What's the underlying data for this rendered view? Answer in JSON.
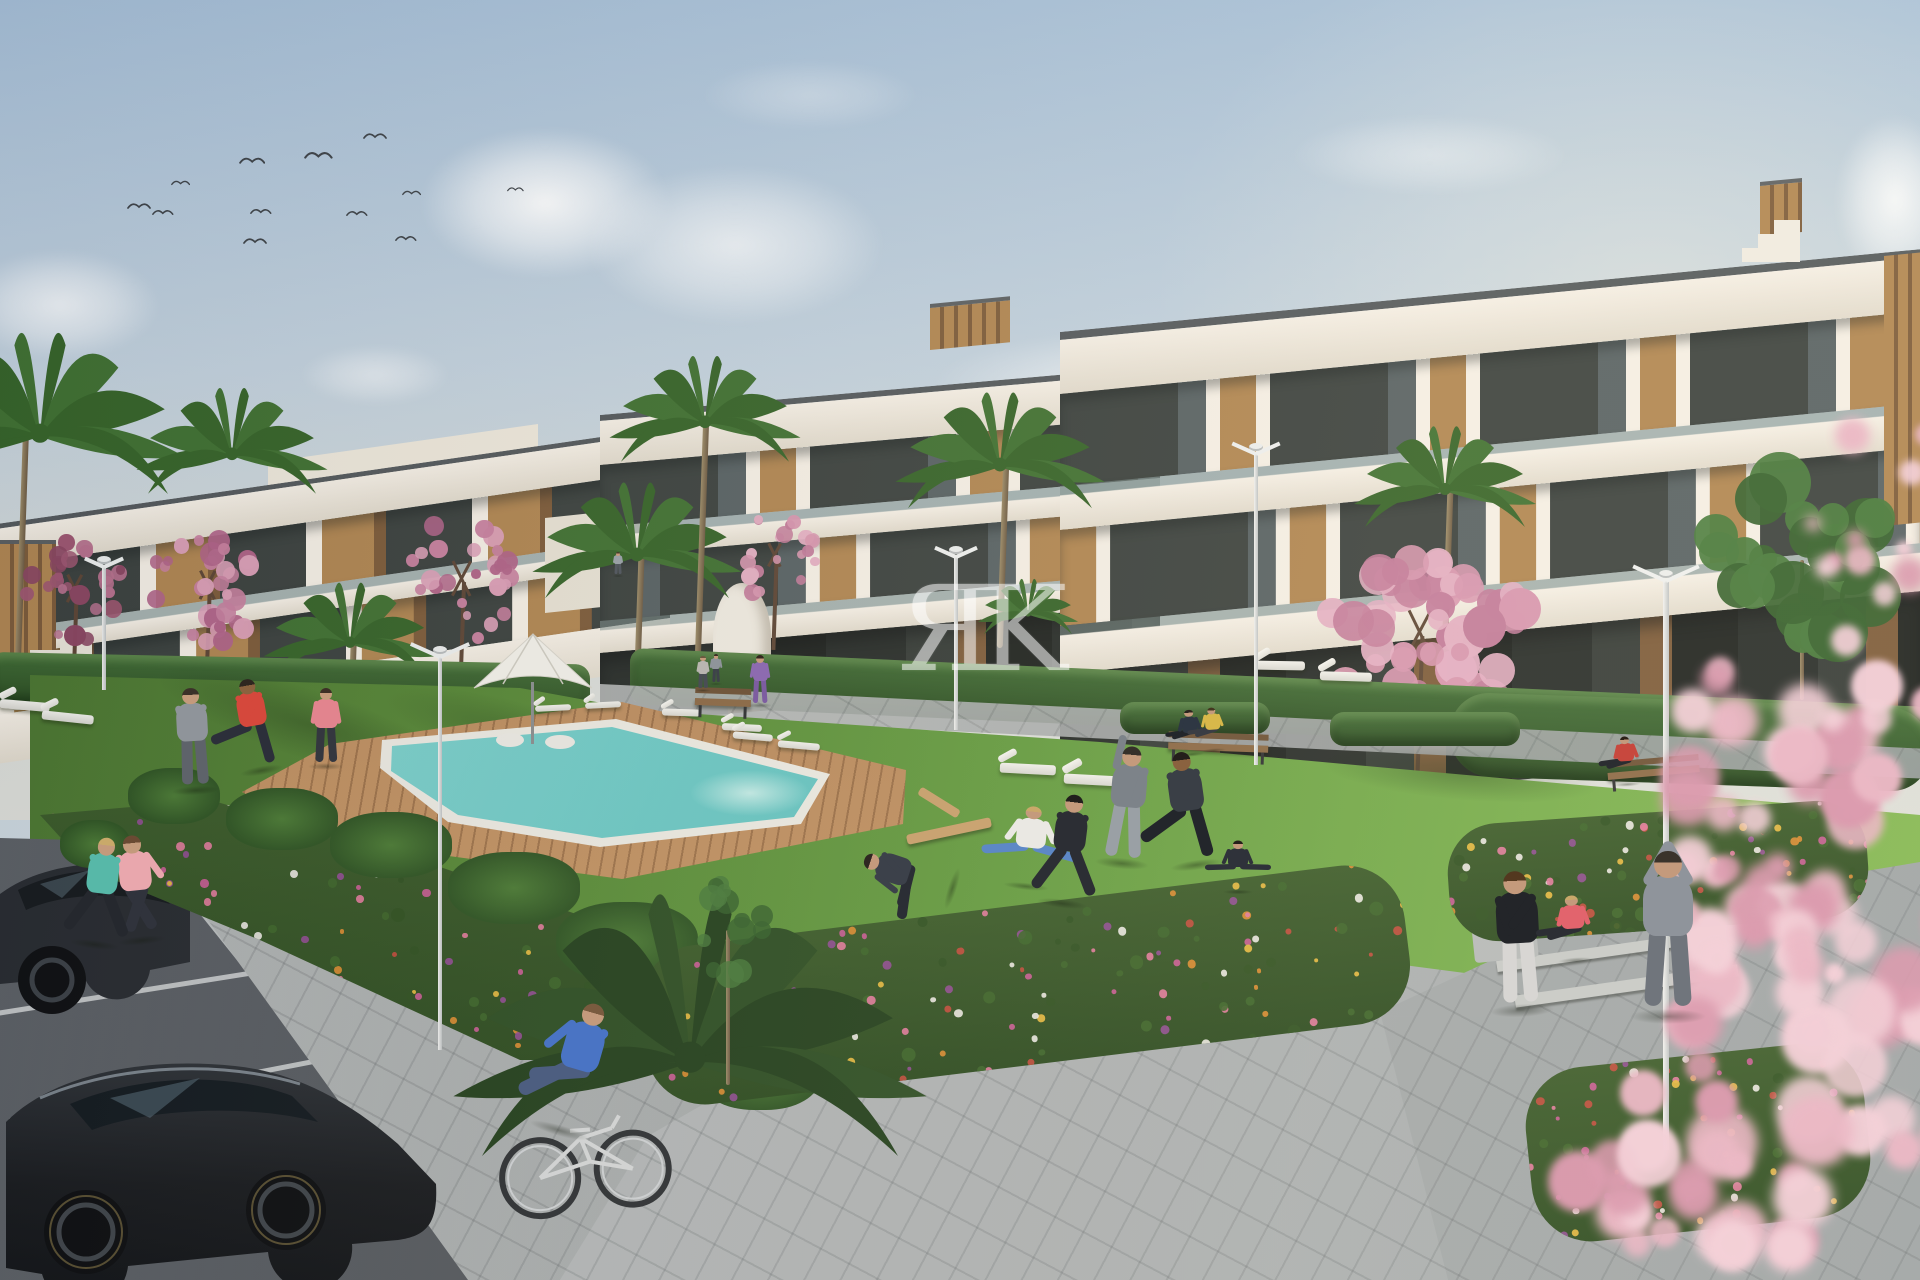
{
  "scene": {
    "type": "architectural-render",
    "description": "New-build white residential apartment complex with wood accents, communal lawn, swimming pool with timber deck, flower beds, joggers, cyclist and parking in front",
    "width": 1920,
    "height": 1280
  },
  "watermark": {
    "text": "ЯK",
    "color": "#ffffff",
    "opacity": 0.55
  },
  "palette": {
    "sky_top": "#a7c0d8",
    "sky_mid": "#c3d2de",
    "sky_low": "#d8dcd8",
    "bldg_white": "#f5efe5",
    "bldg_shade": "#e2dbcd",
    "roof_cap": "#53585b",
    "glass": "#3a403d",
    "glass_light": "#566062",
    "wood": "#b08550",
    "wood_dark": "#7c5a38",
    "hedge": "#31552a",
    "lawn": "#5c8f3a",
    "lawn_light": "#83b455",
    "pool": "#58bdbd",
    "pool_light": "#a7e2dc",
    "deck": "#c79a62",
    "pavement": "#a8acad",
    "road": "#565a5f",
    "line_white": "#d9dcdc",
    "blossom": "#d795ae",
    "blossom_deep": "#a25a77",
    "flower_orange": "#d98a2f",
    "flower_magenta": "#c85b93",
    "flower_purple": "#8e4b8f",
    "flower_yellow": "#e6b93f",
    "lamp": "#eceeec",
    "car": "#17191c",
    "skin": "#c49a7c"
  },
  "birds": [
    {
      "x": 127,
      "y": 200,
      "s": 1.0
    },
    {
      "x": 152,
      "y": 207,
      "s": 0.9
    },
    {
      "x": 171,
      "y": 178,
      "s": 0.8
    },
    {
      "x": 239,
      "y": 154,
      "s": 1.1
    },
    {
      "x": 250,
      "y": 206,
      "s": 0.9
    },
    {
      "x": 243,
      "y": 235,
      "s": 1.0
    },
    {
      "x": 304,
      "y": 148,
      "s": 1.2
    },
    {
      "x": 346,
      "y": 208,
      "s": 0.9
    },
    {
      "x": 363,
      "y": 130,
      "s": 1.0
    },
    {
      "x": 402,
      "y": 188,
      "s": 0.8
    },
    {
      "x": 395,
      "y": 233,
      "s": 0.9
    },
    {
      "x": 507,
      "y": 185,
      "s": 0.7
    }
  ],
  "clouds": [
    {
      "x": 420,
      "y": 128,
      "w": 250,
      "h": 150,
      "o": 0.95
    },
    {
      "x": 585,
      "y": 165,
      "w": 300,
      "h": 160,
      "o": 0.7
    },
    {
      "x": -40,
      "y": 250,
      "w": 200,
      "h": 110,
      "o": 0.75
    },
    {
      "x": 300,
      "y": 345,
      "w": 150,
      "h": 60,
      "o": 0.5
    },
    {
      "x": 930,
      "y": 330,
      "w": 420,
      "h": 110,
      "o": 0.55
    },
    {
      "x": 960,
      "y": 390,
      "w": 300,
      "h": 70,
      "o": 0.5
    },
    {
      "x": 1290,
      "y": 115,
      "w": 280,
      "h": 80,
      "o": 0.4
    },
    {
      "x": 1835,
      "y": 115,
      "w": 120,
      "h": 170,
      "o": 0.85
    },
    {
      "x": 1580,
      "y": 330,
      "w": 260,
      "h": 70,
      "o": 0.4
    },
    {
      "x": 700,
      "y": 60,
      "w": 220,
      "h": 70,
      "o": 0.3
    }
  ],
  "palms": [
    {
      "id": "palm-left-edge",
      "x": 40,
      "y": 430,
      "s": 1.6,
      "trunk": {
        "x": 22,
        "to": 660
      },
      "layer": "back"
    },
    {
      "id": "palm-left-roof",
      "x": 232,
      "y": 452,
      "s": 1.05,
      "trunk": null,
      "layer": "back"
    },
    {
      "id": "palm-court-tall",
      "x": 637,
      "y": 552,
      "s": 1.15,
      "trunk": {
        "x": 639,
        "to": 702
      },
      "layer": "back"
    },
    {
      "id": "palm-court-high",
      "x": 705,
      "y": 420,
      "s": 1.05,
      "trunk": {
        "x": 702,
        "to": 658
      },
      "layer": "back"
    },
    {
      "id": "palm-right-tall",
      "x": 1000,
      "y": 462,
      "s": 1.15,
      "trunk": {
        "x": 1003,
        "to": 648
      },
      "layer": "back"
    },
    {
      "id": "palm-right-far",
      "x": 1445,
      "y": 487,
      "s": 1.0,
      "trunk": {
        "x": 1447,
        "to": 688
      },
      "layer": "back"
    },
    {
      "id": "palm-poolside",
      "x": 350,
      "y": 640,
      "s": 0.95,
      "trunk": {
        "x": 352,
        "to": 742
      },
      "layer": "back"
    },
    {
      "id": "palm-bush",
      "x": 1028,
      "y": 612,
      "s": 0.55,
      "trunk": null,
      "layer": "back"
    },
    {
      "id": "palm-foreground",
      "x": 690,
      "y": 1052,
      "s": 2.6,
      "dark": true,
      "trunk": null,
      "layer": "fore"
    }
  ],
  "green_trees": [
    {
      "id": "green-tree-right",
      "x": 1805,
      "y": 560,
      "rx": 105,
      "ry": 95,
      "trunk": {
        "x": 1802,
        "to": 700
      },
      "layer": "back"
    },
    {
      "id": "sapling-bed",
      "x": 728,
      "y": 930,
      "rx": 50,
      "ry": 60,
      "trunk": {
        "x": 728,
        "to": 1085
      },
      "sparse": true,
      "layer": "fore"
    }
  ],
  "blossoms": [
    {
      "id": "blossom-far-left",
      "x": 75,
      "y": 592,
      "rx": 58,
      "ry": 62,
      "trunkTo": 688,
      "tone": "deep"
    },
    {
      "id": "blossom-left",
      "x": 208,
      "y": 588,
      "rx": 66,
      "ry": 64,
      "trunkTo": 690,
      "tone": "mid"
    },
    {
      "id": "blossom-mid-left",
      "x": 462,
      "y": 582,
      "rx": 58,
      "ry": 78,
      "trunkTo": 700,
      "tone": "mid"
    },
    {
      "id": "blossom-court",
      "x": 775,
      "y": 558,
      "rx": 46,
      "ry": 52,
      "trunkTo": 650,
      "tone": "light"
    },
    {
      "id": "blossom-right",
      "x": 1420,
      "y": 636,
      "rx": 118,
      "ry": 95,
      "trunkTo": 772,
      "tone": "light"
    }
  ],
  "blossoms_fore": [
    {
      "x": 1800,
      "y": 740,
      "rx": 150,
      "ry": 120,
      "n": 26
    },
    {
      "x": 1830,
      "y": 1020,
      "rx": 180,
      "ry": 200,
      "n": 34
    },
    {
      "x": 1700,
      "y": 1180,
      "rx": 160,
      "ry": 120,
      "n": 22
    },
    {
      "x": 1880,
      "y": 500,
      "rx": 90,
      "ry": 130,
      "n": 12
    },
    {
      "x": 1760,
      "y": 920,
      "rx": 120,
      "ry": 90,
      "n": 16
    }
  ],
  "shrubs": [
    [
      128,
      768,
      92,
      56
    ],
    [
      226,
      788,
      112,
      62
    ],
    [
      330,
      812,
      122,
      66
    ],
    [
      448,
      852,
      132,
      72
    ],
    [
      556,
      902,
      142,
      80
    ],
    [
      636,
      972,
      150,
      92
    ],
    [
      60,
      820,
      70,
      48
    ],
    [
      700,
      1040,
      120,
      70
    ]
  ],
  "flower_beds": [
    {
      "mount": "bedL",
      "count": 175,
      "seed": 11
    },
    {
      "mount": "bedR",
      "count": 125,
      "seed": 23
    },
    {
      "mount": "bedSteps",
      "count": 95,
      "seed": 37
    },
    {
      "mount": "bedBR",
      "count": 75,
      "seed": 53
    }
  ],
  "flower_colors": [
    "#d98a2f",
    "#e6b93f",
    "#c85b93",
    "#8e4b8f",
    "#c04a3a",
    "#e8e6e0",
    "#e07a9a"
  ],
  "loungers": [
    {
      "x": 535,
      "y": 697,
      "w": 36,
      "rot": -3
    },
    {
      "x": 585,
      "y": 694,
      "w": 36,
      "rot": -3
    },
    {
      "x": 662,
      "y": 701,
      "w": 38,
      "rot": 2
    },
    {
      "x": 722,
      "y": 715,
      "w": 40,
      "rot": 3
    },
    {
      "x": 733,
      "y": 724,
      "w": 40,
      "rot": 5
    },
    {
      "x": 778,
      "y": 733,
      "w": 42,
      "rot": 5
    },
    {
      "x": 1000,
      "y": 752,
      "w": 56,
      "rot": 3
    },
    {
      "x": 1064,
      "y": 762,
      "w": 58,
      "rot": 3
    },
    {
      "x": 1255,
      "y": 650,
      "w": 50,
      "rot": 1
    },
    {
      "x": 1320,
      "y": 661,
      "w": 52,
      "rot": 2
    },
    {
      "x": 0,
      "y": 690,
      "w": 50,
      "rot": 5
    },
    {
      "x": 42,
      "y": 702,
      "w": 52,
      "rot": 6
    }
  ],
  "benches": [
    {
      "id": "bench-court",
      "x": 695,
      "y": 688,
      "w": 56,
      "rot": 2
    },
    {
      "id": "bench-lawn",
      "x": 1168,
      "y": 733,
      "w": 100,
      "rot": 2
    },
    {
      "id": "bench-right",
      "x": 1608,
      "y": 758,
      "w": 92,
      "rot": -5
    }
  ],
  "lamps": [
    {
      "id": "lamp-pool",
      "x": 440,
      "head": 646,
      "bottom": 1050,
      "w": 56,
      "layer": "mid"
    },
    {
      "id": "lamp-right-lawn",
      "x": 1256,
      "head": 443,
      "bottom": 765,
      "w": 44,
      "layer": "mid"
    },
    {
      "id": "lamp-court",
      "x": 956,
      "head": 546,
      "bottom": 730,
      "w": 38,
      "layer": "mid"
    },
    {
      "id": "lamp-left",
      "x": 104,
      "head": 556,
      "bottom": 690,
      "w": 34,
      "layer": "mid"
    },
    {
      "id": "lamp-walkway",
      "x": 1666,
      "head": 570,
      "bottom": 1150,
      "w": 64,
      "layer": "fore"
    }
  ],
  "steps": [
    {
      "x": 1478,
      "y": 918,
      "w": 152,
      "h": 9,
      "rot": -8
    },
    {
      "x": 1496,
      "y": 948,
      "w": 188,
      "h": 11,
      "rot": -8
    },
    {
      "x": 1514,
      "y": 980,
      "w": 225,
      "h": 12,
      "rot": -8
    }
  ],
  "parking_lines": [
    {
      "x": -10,
      "y": 928,
      "w": 225,
      "rot": -8
    },
    {
      "x": -10,
      "y": 1012,
      "w": 305,
      "rot": -9
    },
    {
      "x": 10,
      "y": 1118,
      "w": 370,
      "rot": -11
    },
    {
      "x": 105,
      "y": 1248,
      "w": 430,
      "rot": -12
    }
  ],
  "bike": {
    "x": 494,
    "y": 1100,
    "w": 180,
    "rot": -4
  },
  "ball": {
    "x": 197,
    "y": 731,
    "r": 8
  },
  "people": [
    {
      "id": "jogger-teal",
      "x": 95,
      "y": 838,
      "h": 106,
      "pose": "run",
      "top": "#57b8a8",
      "bottom": "#25282e",
      "hair": "#c9a96a"
    },
    {
      "id": "jogger-pink",
      "x": 142,
      "y": 836,
      "h": 104,
      "pose": "runb",
      "top": "#e9a7ad",
      "bottom": "#30333c",
      "hair": "#6a4a33"
    },
    {
      "id": "cyclist",
      "x": 560,
      "y": 1000,
      "h": 130,
      "pose": "ride",
      "top": "#4a74c4",
      "bottom": "#4d5e80",
      "hair": "#7a5b3f"
    },
    {
      "id": "ball-player",
      "x": 196,
      "y": 688,
      "h": 102,
      "pose": "stand2",
      "top": "#8f949a",
      "bottom": "#5e636a",
      "hair": "#3c3129"
    },
    {
      "id": "red-kicker",
      "x": 262,
      "y": 678,
      "h": 92,
      "pose": "kick",
      "top": "#d5483c",
      "bottom": "#2c2f3a",
      "hair": "#2e2620",
      "skin": "#8a623f"
    },
    {
      "id": "poolside-woman",
      "x": 326,
      "y": 688,
      "h": 78,
      "pose": "stand",
      "top": "#e2848e",
      "bottom": "#34373f",
      "hair": "#3d2f26"
    },
    {
      "id": "purple-woman",
      "x": 760,
      "y": 655,
      "h": 50,
      "pose": "stand",
      "top": "#8d6bb0",
      "bottom": "#7d5da0",
      "hair": "#33281f"
    },
    {
      "id": "path-figure-a",
      "x": 703,
      "y": 656,
      "h": 34,
      "pose": "stand",
      "top": "#b9b6b0",
      "bottom": "#4a4e55",
      "hair": "#6a5a40"
    },
    {
      "id": "path-figure-b",
      "x": 716,
      "y": 654,
      "h": 30,
      "pose": "stand",
      "top": "#8f949a",
      "bottom": "#3e424a",
      "hair": "#3a2f24"
    },
    {
      "id": "path-figure-c",
      "x": 618,
      "y": 552,
      "h": 24,
      "pose": "stand",
      "top": "#9aa0a6",
      "bottom": "#555a61",
      "hair": "#4a3b2c"
    },
    {
      "id": "squatting-woman",
      "x": 1026,
      "y": 786,
      "h": 100,
      "pose": "squat",
      "top": "#eae8e3",
      "bottom": "#5d88c6",
      "hair": "#caa86a"
    },
    {
      "id": "hoodie-exerciser",
      "x": 1062,
      "y": 795,
      "h": 108,
      "pose": "run",
      "top": "#2c2e34",
      "bottom": "#2c2e34",
      "hair": "#22201d"
    },
    {
      "id": "arm-up-man",
      "x": 1122,
      "y": 747,
      "h": 116,
      "pose": "armup",
      "top": "#7d8389",
      "bottom": "#9aa0a5",
      "hair": "#36302a"
    },
    {
      "id": "leg-stretch-man",
      "x": 1196,
      "y": 752,
      "h": 112,
      "pose": "lunge",
      "top": "#3a3f46",
      "bottom": "#23262b",
      "hair": "#241f1b",
      "skin": "#8a623f"
    },
    {
      "id": "yoga-woman",
      "x": 1238,
      "y": 826,
      "h": 66,
      "pose": "yoga",
      "top": "#2f323a",
      "bottom": "#2f323a",
      "hair": "#241f1a"
    },
    {
      "id": "lying-man",
      "x": 952,
      "y": 796,
      "h": 92,
      "pose": "lie",
      "top": "#3c414a",
      "bottom": "#2b2e35",
      "hair": "#2e2722"
    },
    {
      "id": "bench-sitter-a",
      "x": 1192,
      "y": 702,
      "h": 52,
      "pose": "sit",
      "top": "#2e3743",
      "bottom": "#23262b",
      "hair": "#2a241e"
    },
    {
      "id": "bench-sitter-b",
      "x": 1214,
      "y": 700,
      "h": 50,
      "pose": "sit",
      "top": "#d8b84a",
      "bottom": "#3a3d44",
      "hair": "#44361f"
    },
    {
      "id": "bench-sitter-red",
      "x": 1628,
      "y": 728,
      "h": 56,
      "pose": "sit",
      "top": "#c8483e",
      "bottom": "#2b2d31",
      "hair": "#2c2017"
    },
    {
      "id": "standing-woman",
      "x": 1522,
      "y": 872,
      "h": 138,
      "pose": "stand2",
      "top": "#232529",
      "bottom": "#d8d6d3",
      "hair": "#53381f"
    },
    {
      "id": "sitting-woman-coral",
      "x": 1576,
      "y": 884,
      "h": 76,
      "pose": "sit",
      "top": "#e2646d",
      "bottom": "#2c2e34",
      "hair": "#c9a86a"
    },
    {
      "id": "arms-up-person",
      "x": 1668,
      "y": 852,
      "h": 164,
      "pose": "armsV",
      "top": "#8f949b",
      "bottom": "#70757c",
      "hair": "#3a332b"
    }
  ]
}
